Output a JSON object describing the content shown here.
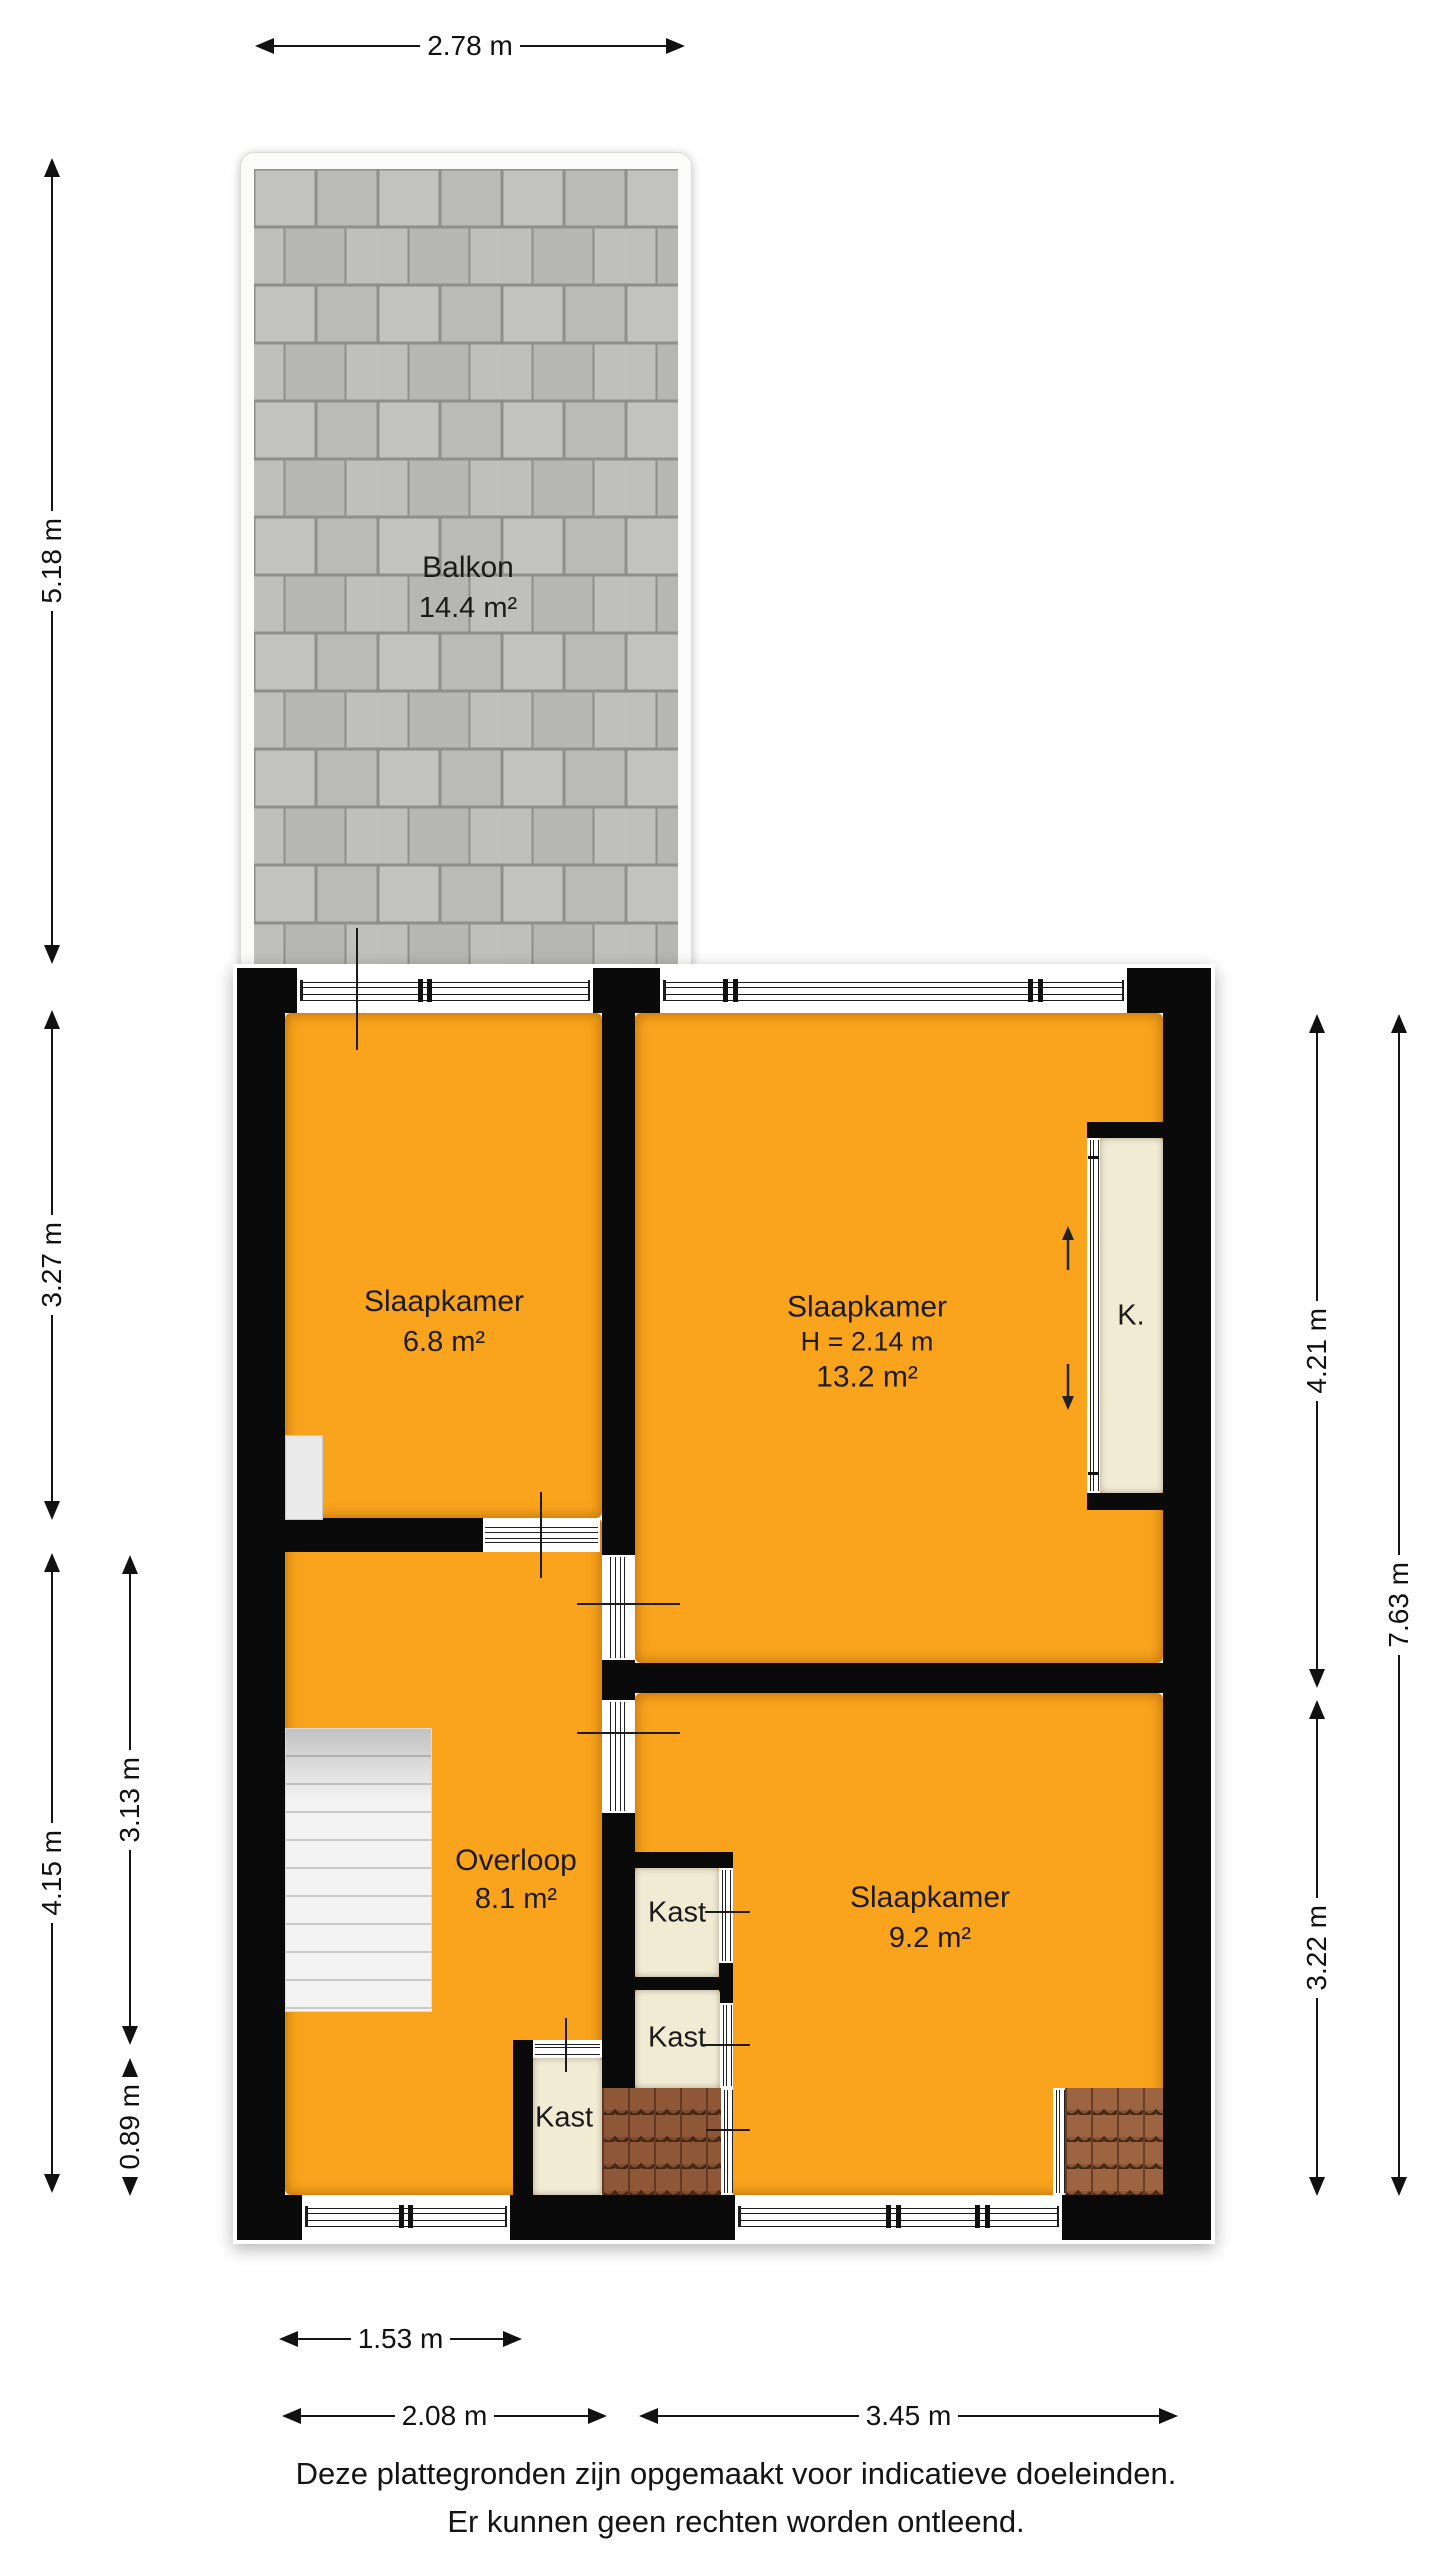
{
  "colors": {
    "floor": "#F9A41C",
    "wall": "#0A0A0A",
    "closet_floor": "#F2EBD3",
    "balcony_tile": "#BDBDB8",
    "roof_tile": "#9C6440",
    "stairs": "#F2F2F2"
  },
  "balcony": {
    "name": "Balkon",
    "area": "14.4 m²"
  },
  "rooms": {
    "bedroom_left": {
      "name": "Slaapkamer",
      "area": "6.8 m²"
    },
    "bedroom_large": {
      "name": "Slaapkamer",
      "height": "H = 2.14 m",
      "area": "13.2 m²"
    },
    "landing": {
      "name": "Overloop",
      "area": "8.1 m²"
    },
    "bedroom_right": {
      "name": "Slaapkamer",
      "area": "9.2 m²"
    },
    "closet_1": {
      "name": "Kast"
    },
    "closet_2": {
      "name": "Kast"
    },
    "closet_3": {
      "name": "Kast"
    },
    "closet_k": {
      "name": "K."
    }
  },
  "dimensions": {
    "top_width": "2.78 m",
    "balcony_height": "5.18 m",
    "bedroom_left_height": "3.27 m",
    "landing_height": "4.15 m",
    "landing_inner_height": "3.13 m",
    "closet3_height": "0.89 m",
    "bedroom_large_height": "4.21 m",
    "right_total_height": "7.63 m",
    "bedroom_right_height": "3.22 m",
    "stairs_width": "1.53 m",
    "landing_width": "2.08 m",
    "right_width": "3.45 m"
  },
  "footer": {
    "line1": "Deze plattegronden zijn opgemaakt voor indicatieve doeleinden.",
    "line2": "Er kunnen geen rechten worden ontleend."
  }
}
